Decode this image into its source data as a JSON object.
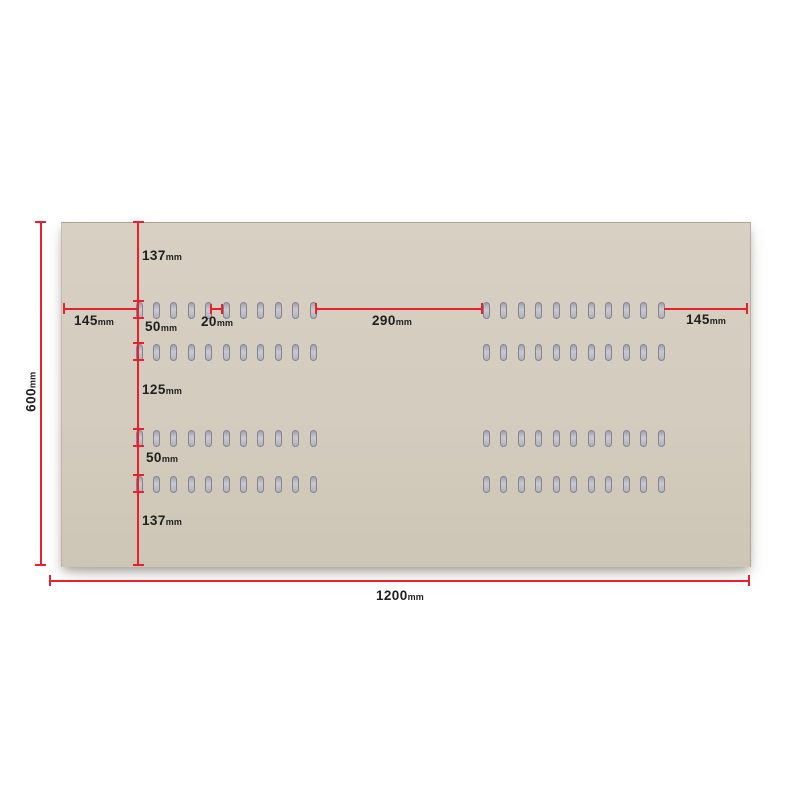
{
  "figure": {
    "kind": "dimensioned technical drawing of a slotted cardboard panel",
    "background_color": "#ffffff",
    "panel_color": "#d4ccbe",
    "dimension_line_color": "#e8212e",
    "label_text_color": "#1f1f1d"
  },
  "panel": {
    "rows_of_slots": 4,
    "slot_groups_per_row": 2,
    "slots_per_group": 11,
    "total_slots": 88,
    "slot_color": "#c0c0ca",
    "slot_border_color": "#84848f"
  },
  "dimensions": {
    "width": {
      "value": "1200",
      "unit": "mm"
    },
    "height": {
      "value": "600",
      "unit": "mm"
    },
    "top_margin": {
      "value": "137",
      "unit": "mm"
    },
    "left_margin": {
      "value": "145",
      "unit": "mm"
    },
    "gap_row1_row2": {
      "value": "50",
      "unit": "mm"
    },
    "slot_pitch": {
      "value": "20",
      "unit": "mm"
    },
    "center_gap": {
      "value": "290",
      "unit": "mm"
    },
    "right_margin": {
      "value": "145",
      "unit": "mm"
    },
    "gap_row2_row3": {
      "value": "125",
      "unit": "mm"
    },
    "gap_row3_row4": {
      "value": "50",
      "unit": "mm"
    },
    "bottom_margin": {
      "value": "137",
      "unit": "mm"
    }
  }
}
